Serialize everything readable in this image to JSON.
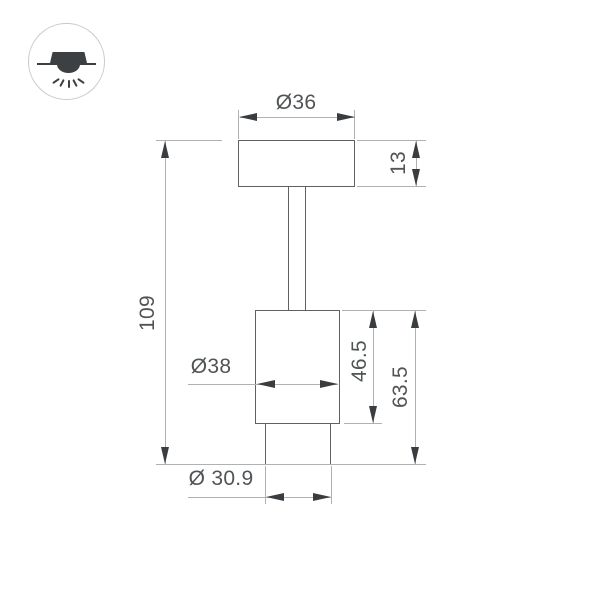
{
  "type_icon": {
    "name": "ceiling-light-icon"
  },
  "drawing": {
    "title": "luminaire-dimension-drawing",
    "dims": {
      "top_diameter": "Ø36",
      "plate_thickness": "13",
      "overall_height": "109",
      "body_diameter": "Ø38",
      "body_height": "46.5",
      "head_height": "63.5",
      "front_diameter": "Ø 30.9"
    },
    "colors": {
      "background": "#ffffff",
      "outline": "#5f6163",
      "dim_line": "#aeb2b5",
      "arrow": "#3a3d40",
      "text": "#515456",
      "icon_stroke": "#c7c9cb",
      "icon_fill": "#3d4043"
    }
  }
}
